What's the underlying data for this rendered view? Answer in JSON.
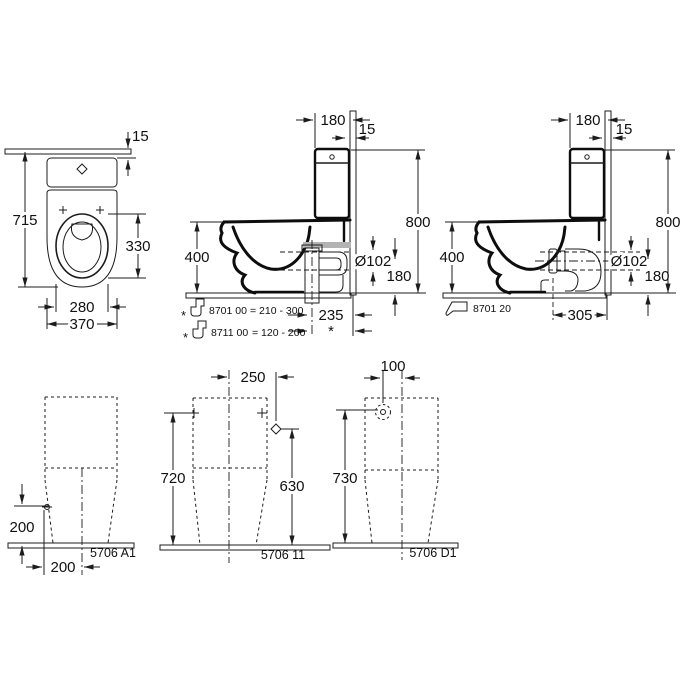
{
  "drawing": {
    "front_view": {
      "dim_wall_gap": "15",
      "dim_total_height": "715",
      "dim_seat_opening": "330",
      "dim_seat_width": "280",
      "dim_total_width": "370"
    },
    "side_view_vertical": {
      "dim_cistern_depth": "180",
      "dim_wall_gap": "15",
      "dim_height": "800",
      "dim_bowl_height": "400",
      "dim_outlet_diameter": "Ø102",
      "dim_outlet_height": "180",
      "dim_outlet_to_wall": "235",
      "dim_variable_marker": "*",
      "notes": [
        {
          "marker": "*",
          "code": "8701 00",
          "range": "= 210 - 300"
        },
        {
          "marker": "*",
          "code": "8711 00",
          "range": "= 120 - 200"
        }
      ]
    },
    "side_view_horizontal": {
      "dim_cistern_depth": "180",
      "dim_wall_gap": "15",
      "dim_height": "800",
      "dim_bowl_height": "400",
      "dim_outlet_diameter": "Ø102",
      "dim_outlet_height": "180",
      "dim_outlet_to_wall": "305",
      "note": {
        "code": "8701 20"
      }
    },
    "rear_view_a1": {
      "dim_supply_height": "200",
      "dim_supply_offset": "200",
      "model": "5706 A1"
    },
    "rear_view_center": {
      "dim_supply_offset": "250",
      "dim_height": "720",
      "dim_supply_height": "630",
      "model": "5706 11"
    },
    "rear_view_d1": {
      "dim_supply_offset": "100",
      "dim_supply_height": "730",
      "model": "5706 D1"
    }
  }
}
